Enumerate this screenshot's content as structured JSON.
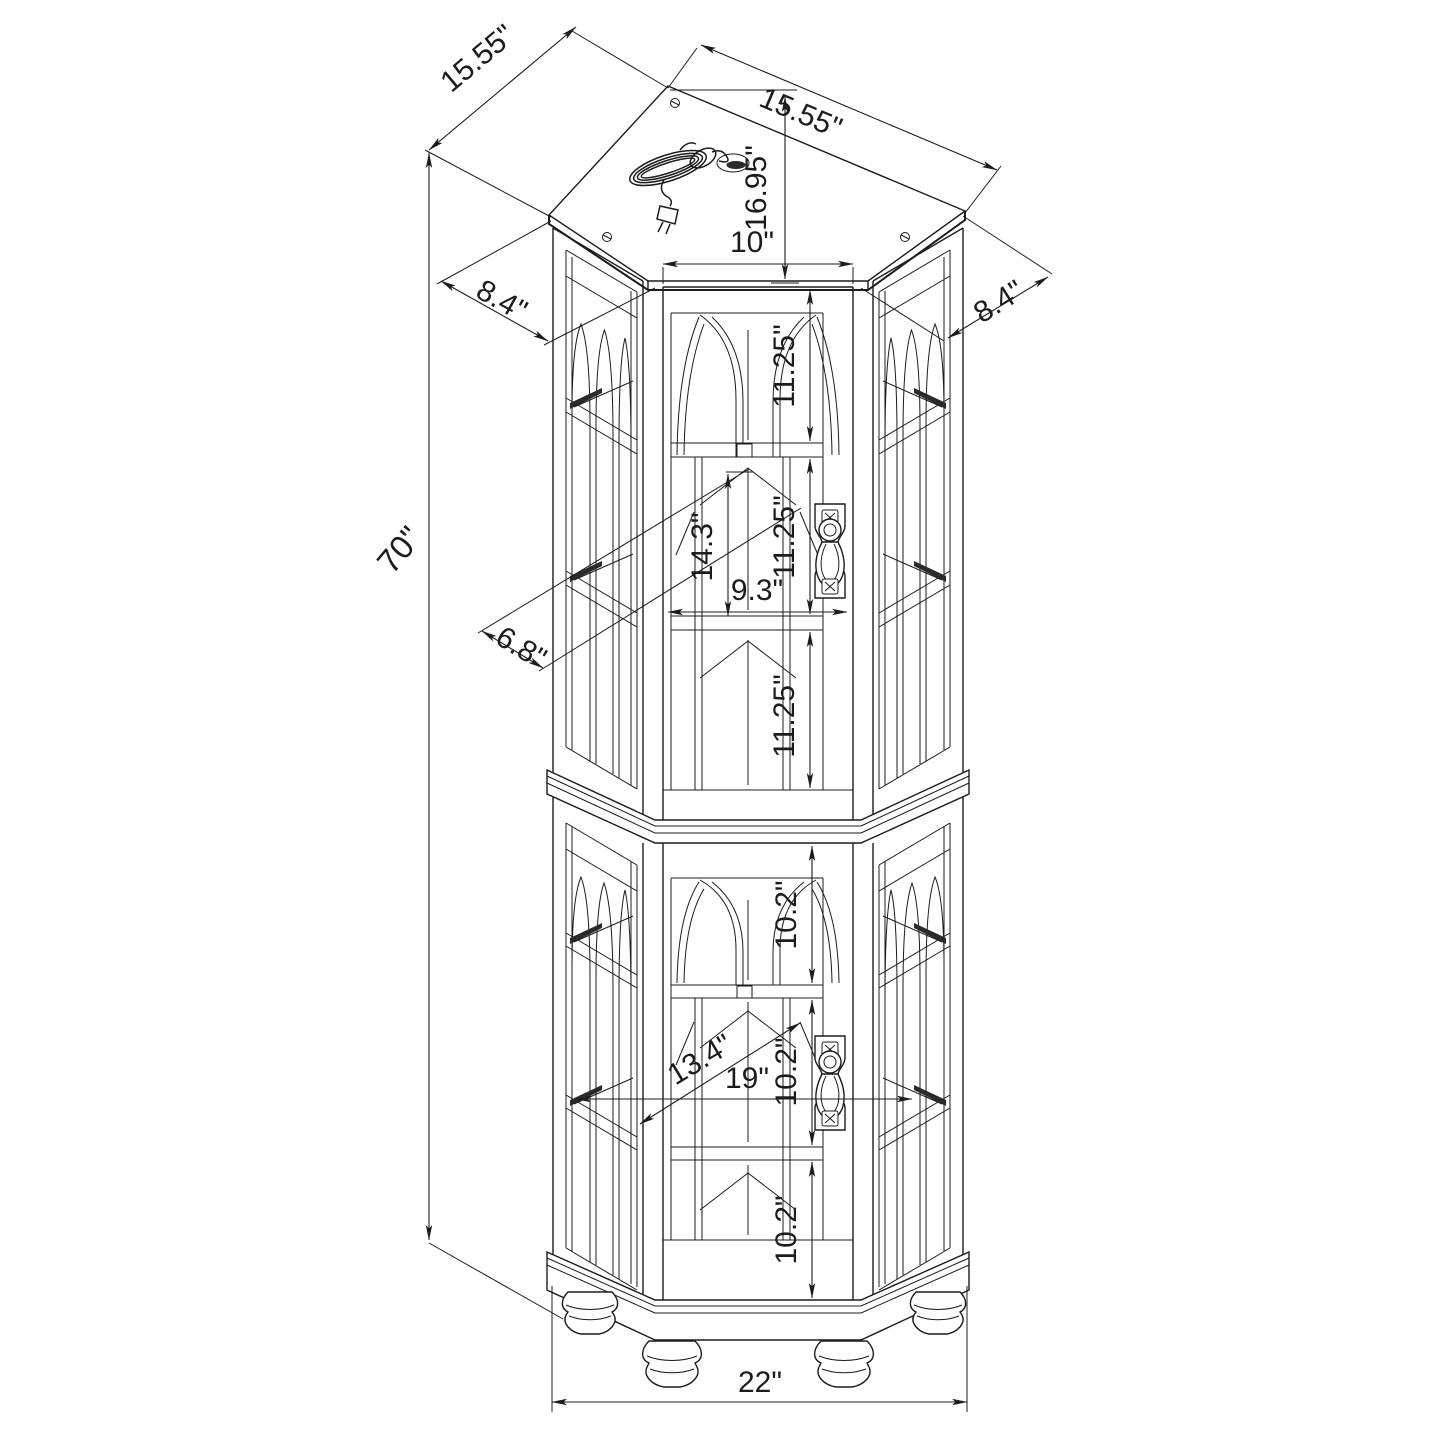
{
  "title": "Corner curio cabinet dimensioned line drawing",
  "units": "inches",
  "palette": {
    "line": "#1c1c1c",
    "background": "#ffffff"
  },
  "dims": {
    "top_edge_left": "15.55\"",
    "top_edge_right": "15.55\"",
    "top_depth": "16.95\"",
    "door_top_width": "10\"",
    "side_panel_left": "8.4\"",
    "side_panel_right": "8.4\"",
    "overall_height": "70\"",
    "upper_bay_1": "11.25\"",
    "upper_bay_2": "11.25\"",
    "upper_bay_3": "11.25\"",
    "upper_opening_height": "14.3\"",
    "upper_inner_width": "9.3\"",
    "side_glass_width": "6.8\"",
    "lower_bay_1": "10.2\"",
    "lower_bay_2": "10.2\"",
    "lower_bay_3": "10.2\"",
    "lower_diagonal": "13.4\"",
    "lower_inner_width": "19\"",
    "base_width": "22\""
  }
}
